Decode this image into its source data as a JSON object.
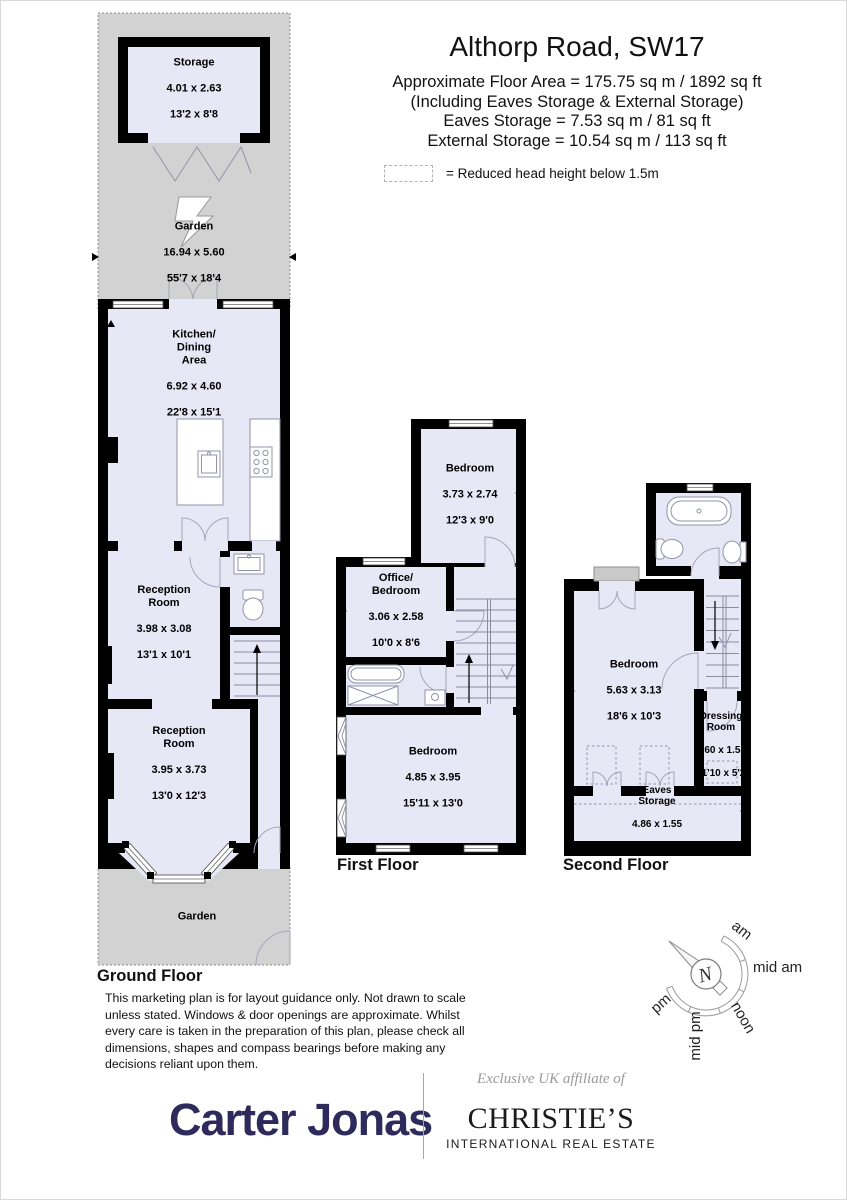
{
  "header": {
    "title": "Althorp Road, SW17",
    "lines": [
      "Approximate Floor Area = 175.75 sq m / 1892 sq ft",
      "(Including Eaves Storage & External Storage)",
      "Eaves Storage = 7.53 sq m / 81 sq ft",
      "External Storage = 10.54 sq m / 113 sq ft"
    ],
    "legend_text": "= Reduced head height below 1.5m"
  },
  "floors": {
    "ground": {
      "label": "Ground Floor"
    },
    "first": {
      "label": "First Floor"
    },
    "second": {
      "label": "Second Floor"
    }
  },
  "rooms": {
    "storage": {
      "name": "Storage",
      "metric": "4.01 x 2.63",
      "imperial": "13'2 x 8'8"
    },
    "garden_rear": {
      "name": "Garden",
      "metric": "16.94 x 5.60",
      "imperial": "55'7 x 18'4"
    },
    "kitchen": {
      "name": "Kitchen/\nDining\nArea",
      "metric": "6.92 x 4.60",
      "imperial": "22'8 x 15'1"
    },
    "reception_1": {
      "name": "Reception\nRoom",
      "metric": "3.98 x 3.08",
      "imperial": "13'1 x 10'1"
    },
    "reception_2": {
      "name": "Reception\nRoom",
      "metric": "3.95 x 3.73",
      "imperial": "13'0 x 12'3"
    },
    "garden_front": {
      "name": "Garden"
    },
    "bedroom_first_rear": {
      "name": "Bedroom",
      "metric": "3.73 x 2.74",
      "imperial": "12'3 x 9'0"
    },
    "office_bedroom": {
      "name": "Office/\nBedroom",
      "metric": "3.06 x 2.58",
      "imperial": "10'0 x 8'6"
    },
    "bedroom_first_front": {
      "name": "Bedroom",
      "metric": "4.85 x 3.95",
      "imperial": "15'11 x 13'0"
    },
    "bedroom_second": {
      "name": "Bedroom",
      "metric": "5.63 x 3.13",
      "imperial": "18'6 x 10'3"
    },
    "dressing_room": {
      "name": "Dressing\nRoom",
      "metric": "3.60 x 1.58",
      "imperial": "11'10 x 5'2"
    },
    "eaves_storage": {
      "name": "Eaves\nStorage",
      "metric": "4.86 x 1.55",
      "imperial": "15'11 x 5'1"
    }
  },
  "disclaimer": "This marketing plan is for layout guidance only. Not drawn to scale unless stated. Windows & door openings are approximate. Whilst every care is taken in the preparation of this plan,  please check all dimensions, shapes and compass bearings before making any decisions reliant upon them.",
  "compass": {
    "north": "N",
    "labels": [
      "am",
      "mid am",
      "noon",
      "mid pm",
      "pm"
    ]
  },
  "footer": {
    "agent": "Carter Jonas",
    "affiliate_note": "Exclusive UK affiliate of",
    "brand": "CHRISTIE’S",
    "brand_sub": "INTERNATIONAL REAL ESTATE"
  },
  "colors": {
    "room_fill": "#e7e8f6",
    "wall": "#000000",
    "garden": "#d2d2d2",
    "brand_navy": "#2e2a5c"
  }
}
